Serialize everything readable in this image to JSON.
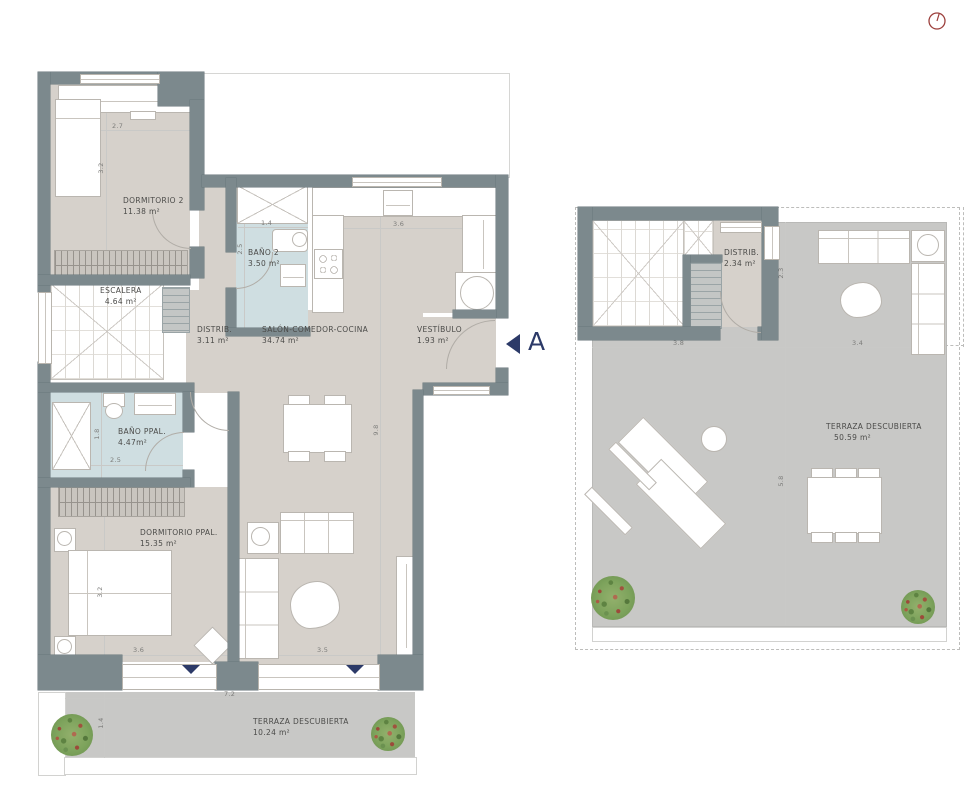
{
  "section_marker": {
    "label": "A"
  },
  "icons": {
    "top_right": "clock-icon",
    "entrance_markers": "arrow-down-icon",
    "section_pointer": "arrow-left-icon",
    "vegetation": "plant-icon"
  },
  "colors": {
    "wall": "#7c898d",
    "interior_floor": "#d6d1cb",
    "bathroom_floor": "#cfdee1",
    "terrace_floor": "#c8c8c6",
    "accent_navy": "#2c3a68",
    "indicator_red": "#9c3f3c"
  },
  "plan_left": {
    "rooms": {
      "dormitorio2": {
        "name": "DORMITORIO 2",
        "area": "11.38 m²"
      },
      "bano2": {
        "name": "BAÑO 2",
        "area": "3.50 m²"
      },
      "escalera": {
        "name": "ESCALERA",
        "area": "4.64 m²"
      },
      "distrib": {
        "name": "DISTRIB.",
        "area": "3.11 m²"
      },
      "salon": {
        "name": "SALÓN-COMEDOR-COCINA",
        "area": "34.74 m²"
      },
      "vestibulo": {
        "name": "VESTÍBULO",
        "area": "1.93 m²"
      },
      "banoppal": {
        "name": "BAÑO PPAL.",
        "area": "4.47m²"
      },
      "dormppal": {
        "name": "DORMITORIO PPAL.",
        "area": "15.35 m²"
      },
      "terraza": {
        "name": "TERRAZA DESCUBIERTA",
        "area": "10.24 m²"
      }
    },
    "dims": {
      "dorm2_width": "2.7",
      "dorm2_depth": "3.2",
      "bano2_width": "1.4",
      "bano2_depth": "2.5",
      "salon_top_width": "3.6",
      "salon_depth": "9.8",
      "banoppal_depth": "1.8",
      "banoppal_width": "2.5",
      "dormppal_depth": "3.2",
      "dormppal_width": "3.6",
      "salon_bottom_width": "3.5",
      "terraza_width": "7.2",
      "terraza_depth": "1.4"
    }
  },
  "plan_right": {
    "rooms": {
      "distrib": {
        "name": "DISTRIB.",
        "area": "2.34 m²"
      },
      "terraza": {
        "name": "TERRAZA DESCUBIERTA",
        "area": "50.59 m²"
      }
    },
    "dims": {
      "stair_width": "3.8",
      "terraza_width": "3.4",
      "distrib_depth": "2.3",
      "terraza_depth": "5.8"
    }
  }
}
